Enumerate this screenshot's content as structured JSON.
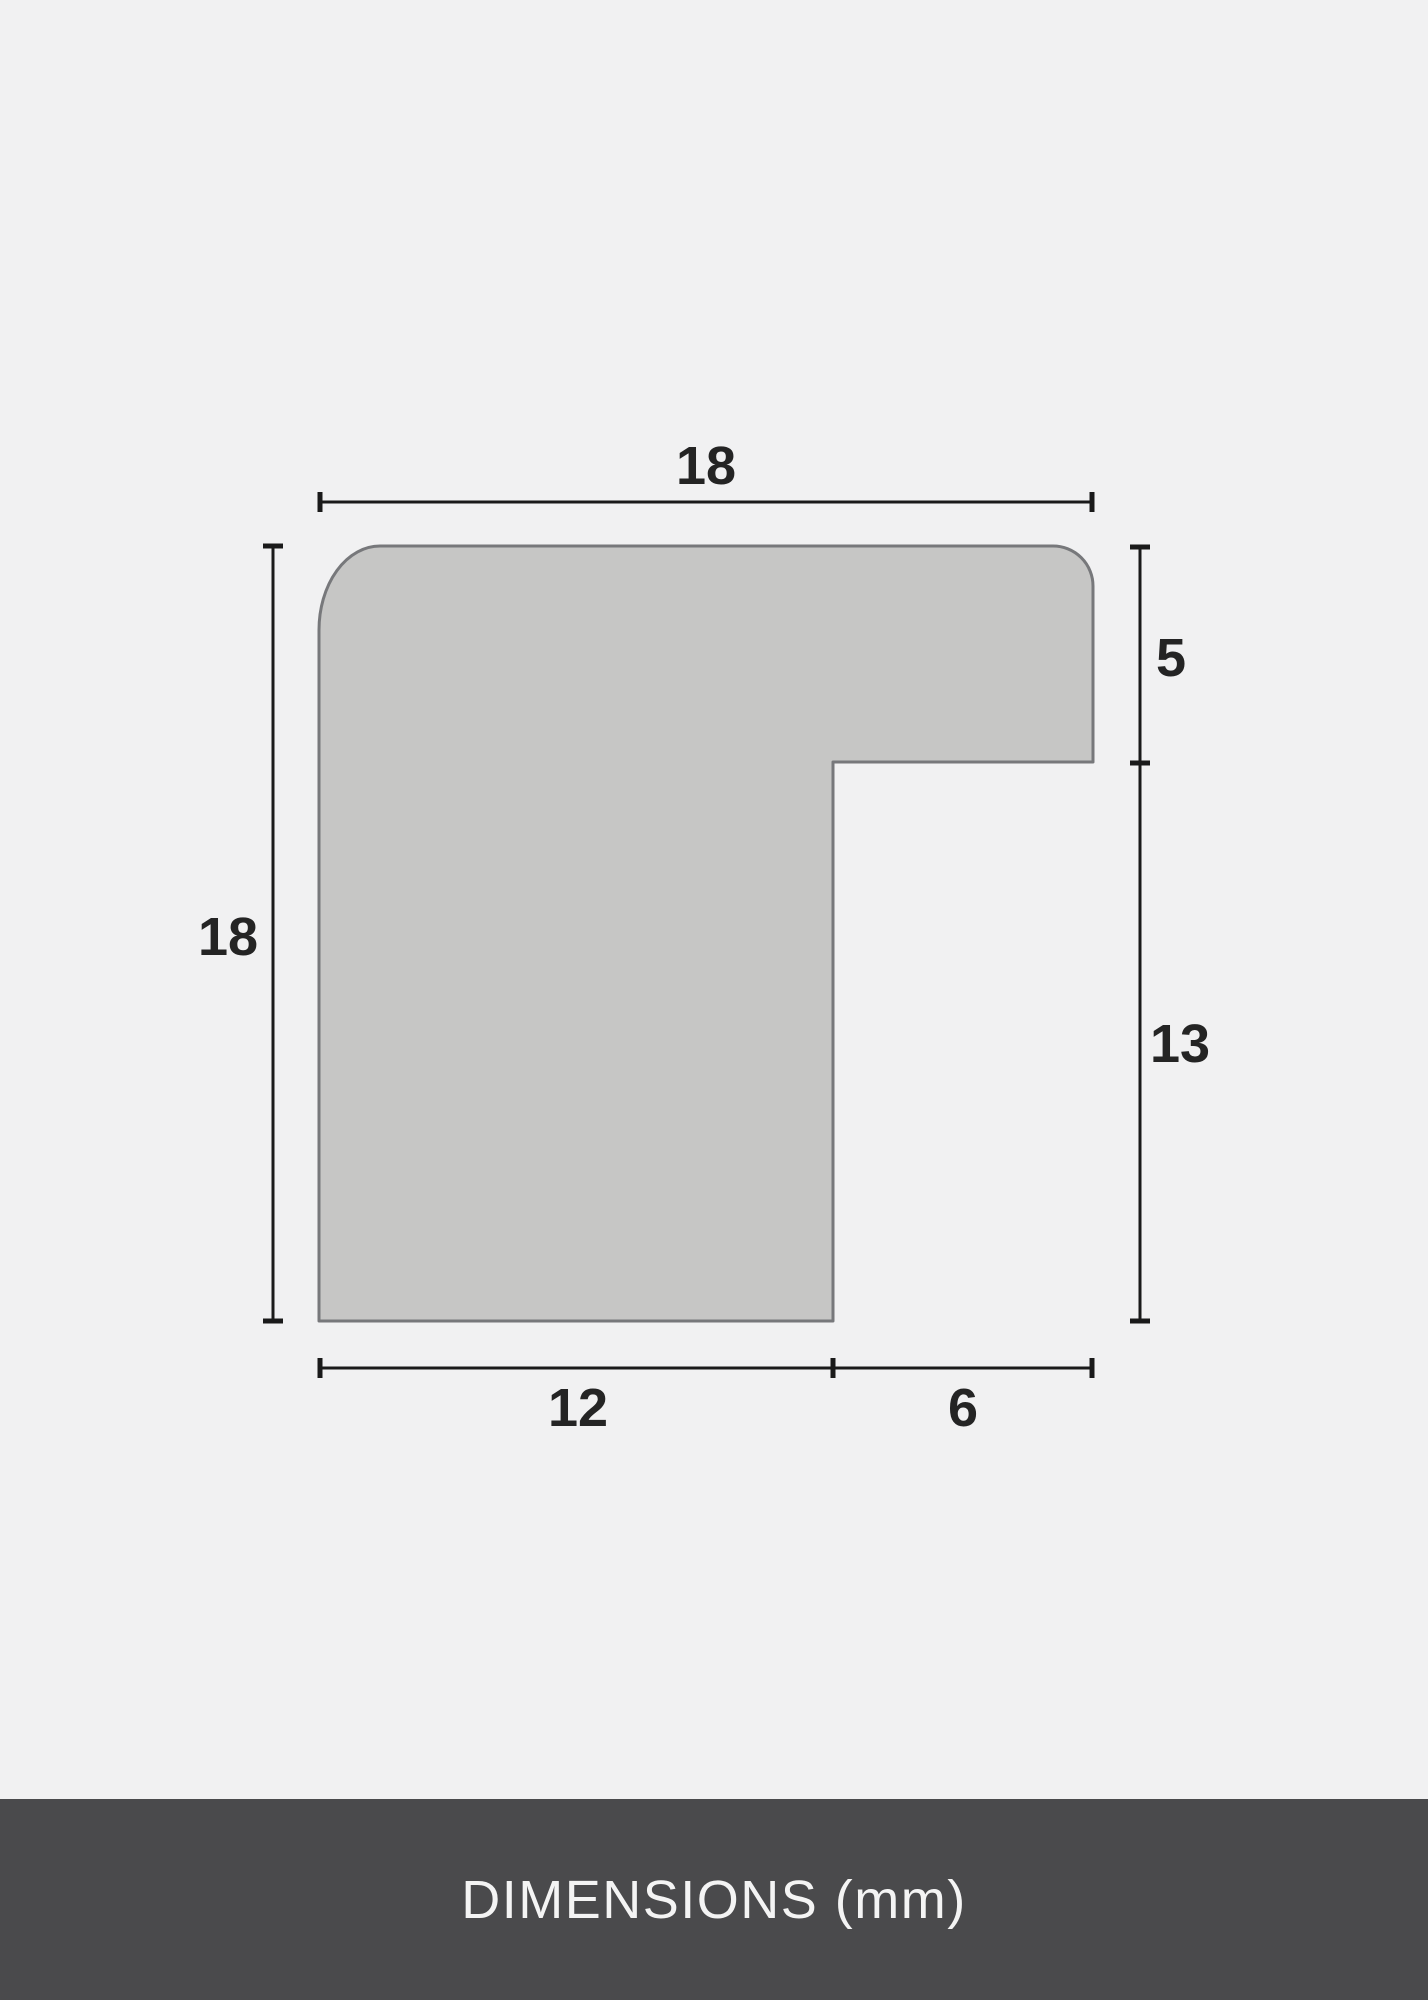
{
  "drawing": {
    "labels": {
      "top_width": "18",
      "left_height": "18",
      "right_upper": "5",
      "right_lower": "13",
      "bottom_inner": "12",
      "bottom_outer": "6"
    },
    "colors": {
      "background": "#f1f1f2",
      "profile_fill": "#c6c6c5",
      "profile_stroke": "#77787b",
      "dimension_line": "#1a1a1a",
      "label_text": "#242424"
    }
  },
  "footer": {
    "title": "DIMENSIONS (mm)",
    "background": "#4a4a4c",
    "text_color": "#f4f4f4"
  }
}
